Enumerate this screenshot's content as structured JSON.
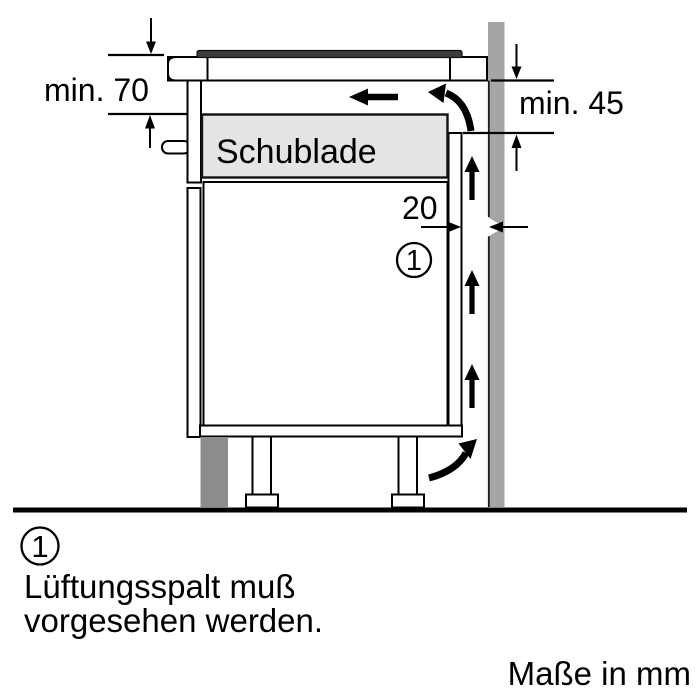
{
  "diagram": {
    "labels": {
      "drawer": "Schublade",
      "dim_top_clearance": "min. 70",
      "dim_rear_clearance": "min. 45",
      "dim_vent_gap": "20",
      "callout_number": "1"
    },
    "colors": {
      "wall": "#a5a5a5",
      "worktop_edge": "#d5d5d5",
      "hob_glass": "#3c3c3c",
      "hob_rail": "#dadada",
      "hob_clamp": "#cdd0d0",
      "drawer_fill": "#e4e4e4",
      "plinth": "#8c8c8c",
      "outline": "#000000"
    },
    "arrows": {
      "airflow_up_count": 3,
      "airflow_left": "left-arrow",
      "airflow_curved_top": "curved-arrow-up-left",
      "airflow_curved_bottom": "curved-arrow-up-right"
    }
  },
  "footnote": {
    "number": "1",
    "line1": "Lüftungsspalt muß",
    "line2": "vorgesehen werden."
  },
  "units_note": "Maße in mm"
}
